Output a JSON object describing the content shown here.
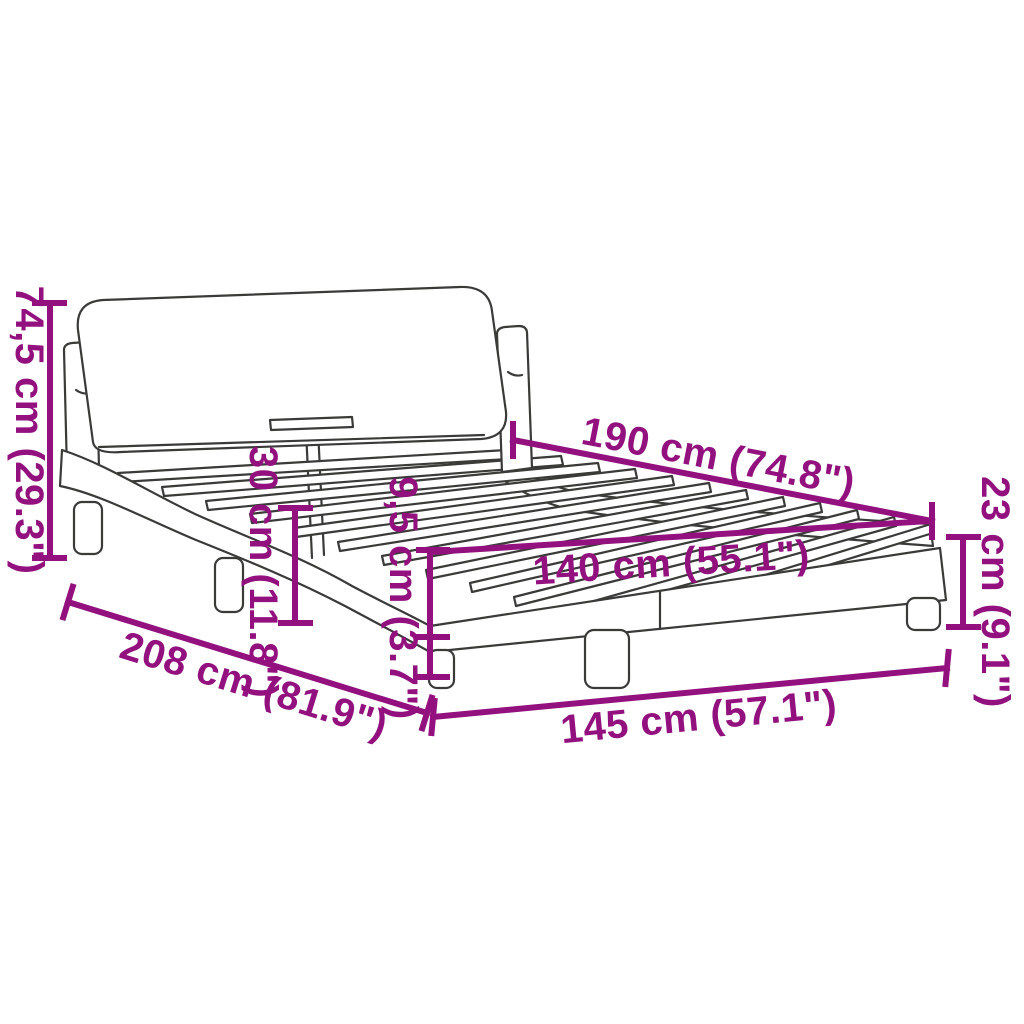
{
  "diagram": {
    "background_color": "#ffffff",
    "accent_color": "#93117e",
    "line_color": "#3a3a39",
    "dimensions": {
      "headboard_height": "74,5 cm (29.3\")",
      "frame_height": "30 cm (11.8\")",
      "rail_height": "9,5 cm (3.7\")",
      "slat_length": "190 cm (74.8\")",
      "base_height": "23 cm (9.1\")",
      "inner_width": "140 cm (55.1\")",
      "total_length": "208 cm (81.9\")",
      "total_width": "145 cm (57.1\")"
    }
  }
}
